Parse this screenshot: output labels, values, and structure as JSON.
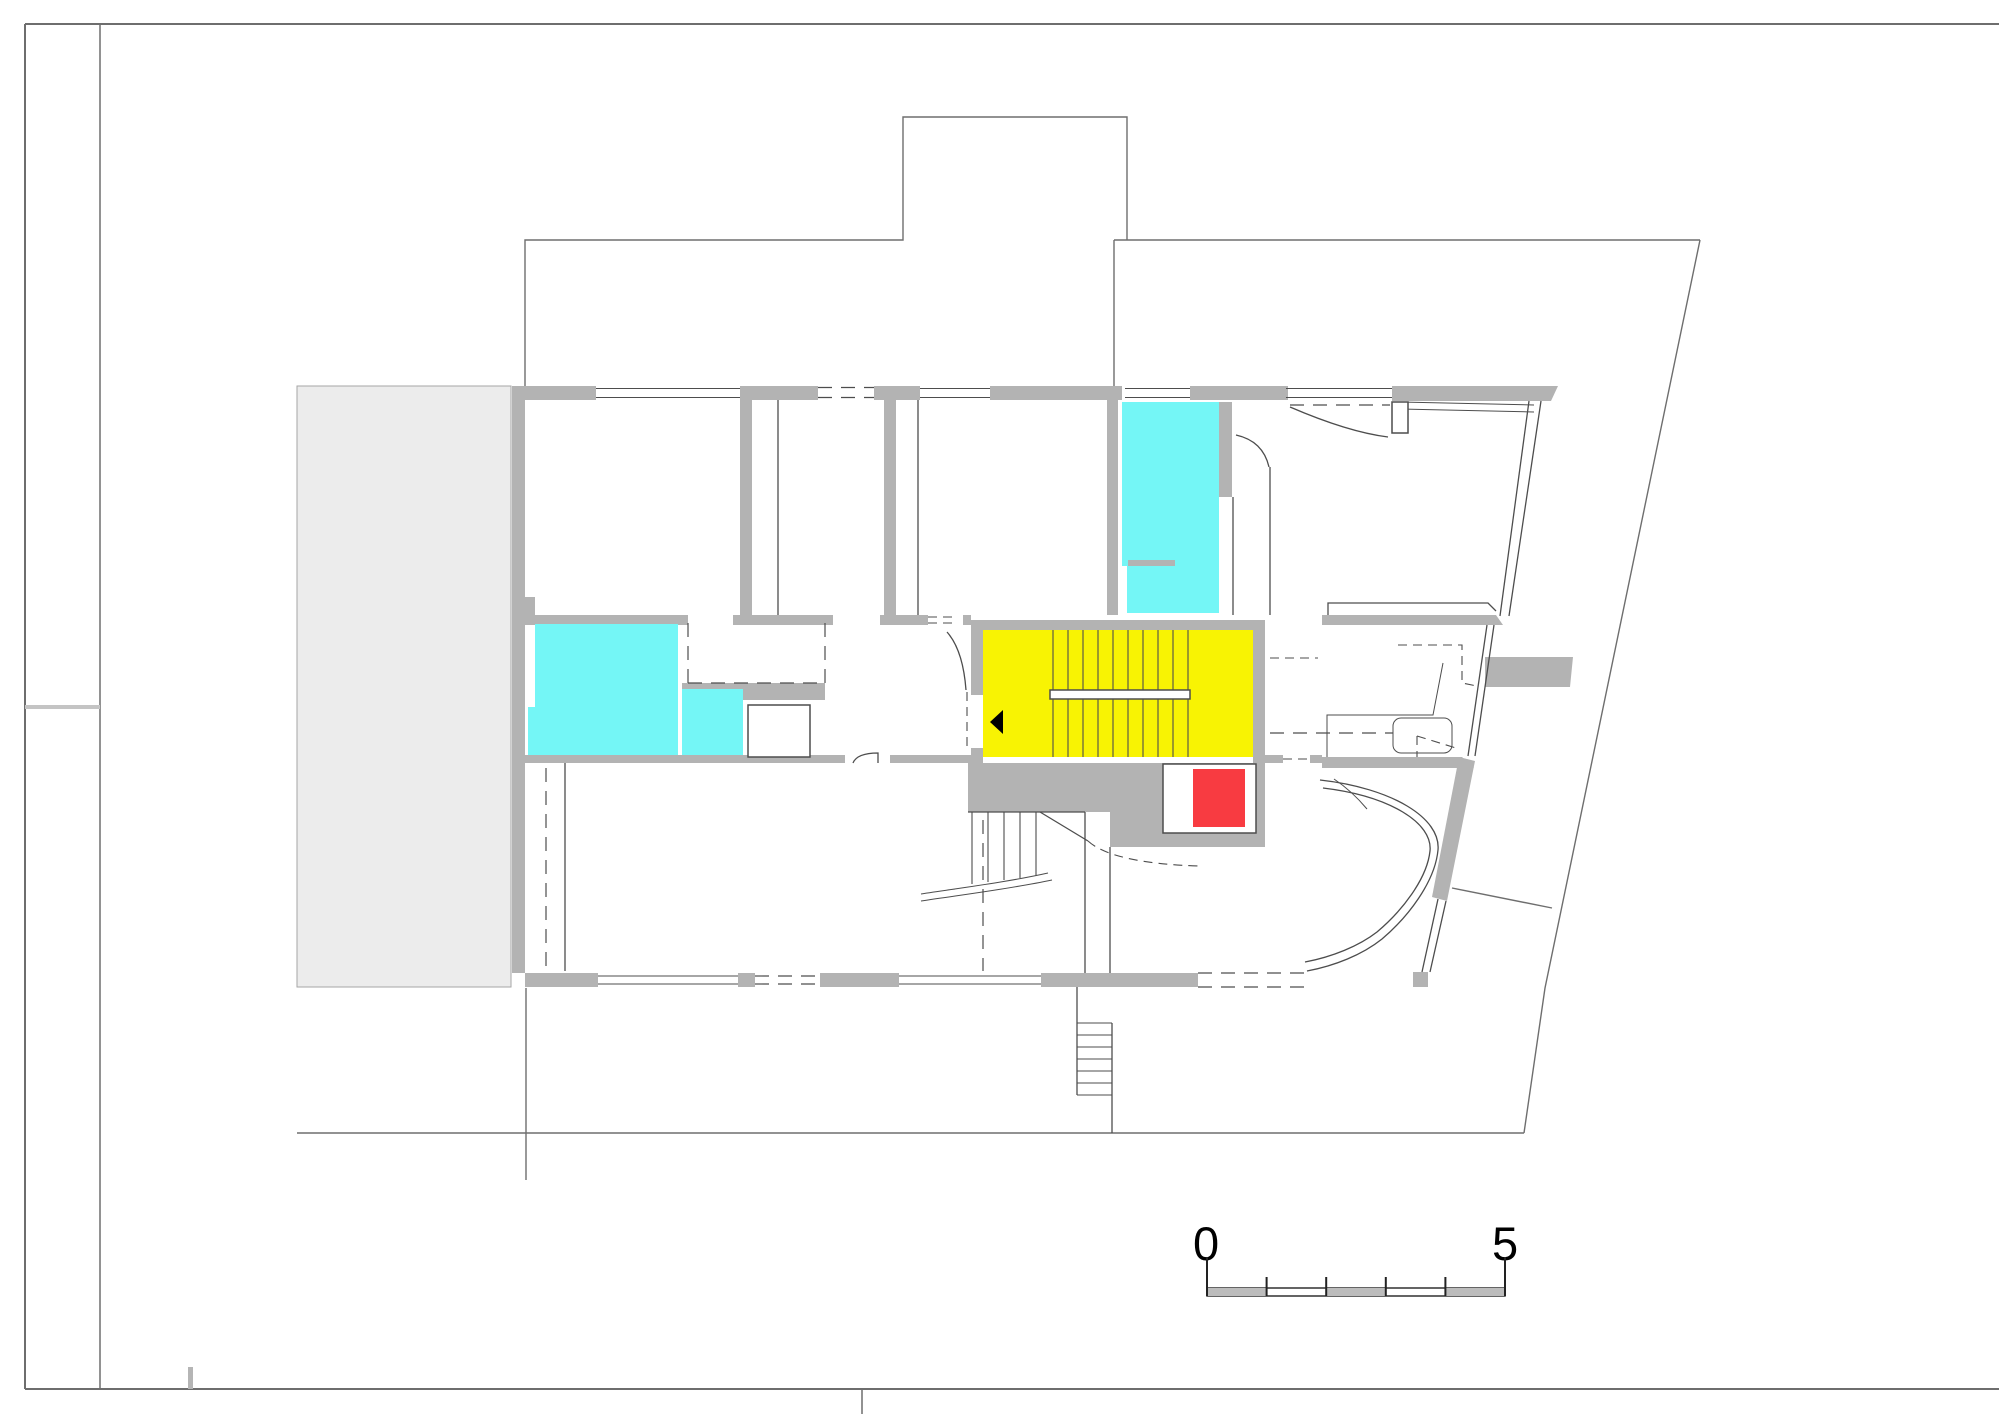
{
  "document": {
    "type": "architectural-floor-plan",
    "sheet": "upper floor plan with highlighted stair core"
  },
  "colors": {
    "wall": "#b3b3b3",
    "terrace": "#ececec",
    "terrace_edge": "#a6a6a6",
    "highlight_cyan": "#74f6f6",
    "highlight_yellow": "#f8f303",
    "highlight_red": "#f83b41",
    "line": "#4d4d4d",
    "frame": "#6e6e6e",
    "scale_fill": "#bcbcbc"
  },
  "regions": {
    "stair_core": "yellow highlighted staircase with handrail and direction arrow",
    "elevator": "red highlighted shaft beside staircase",
    "wet_rooms": "cyan highlighted rooms (3)",
    "terrace": "light gray deck on the west side"
  },
  "scale_bar": {
    "label_start": "0",
    "label_end": "5",
    "segments": 5
  }
}
